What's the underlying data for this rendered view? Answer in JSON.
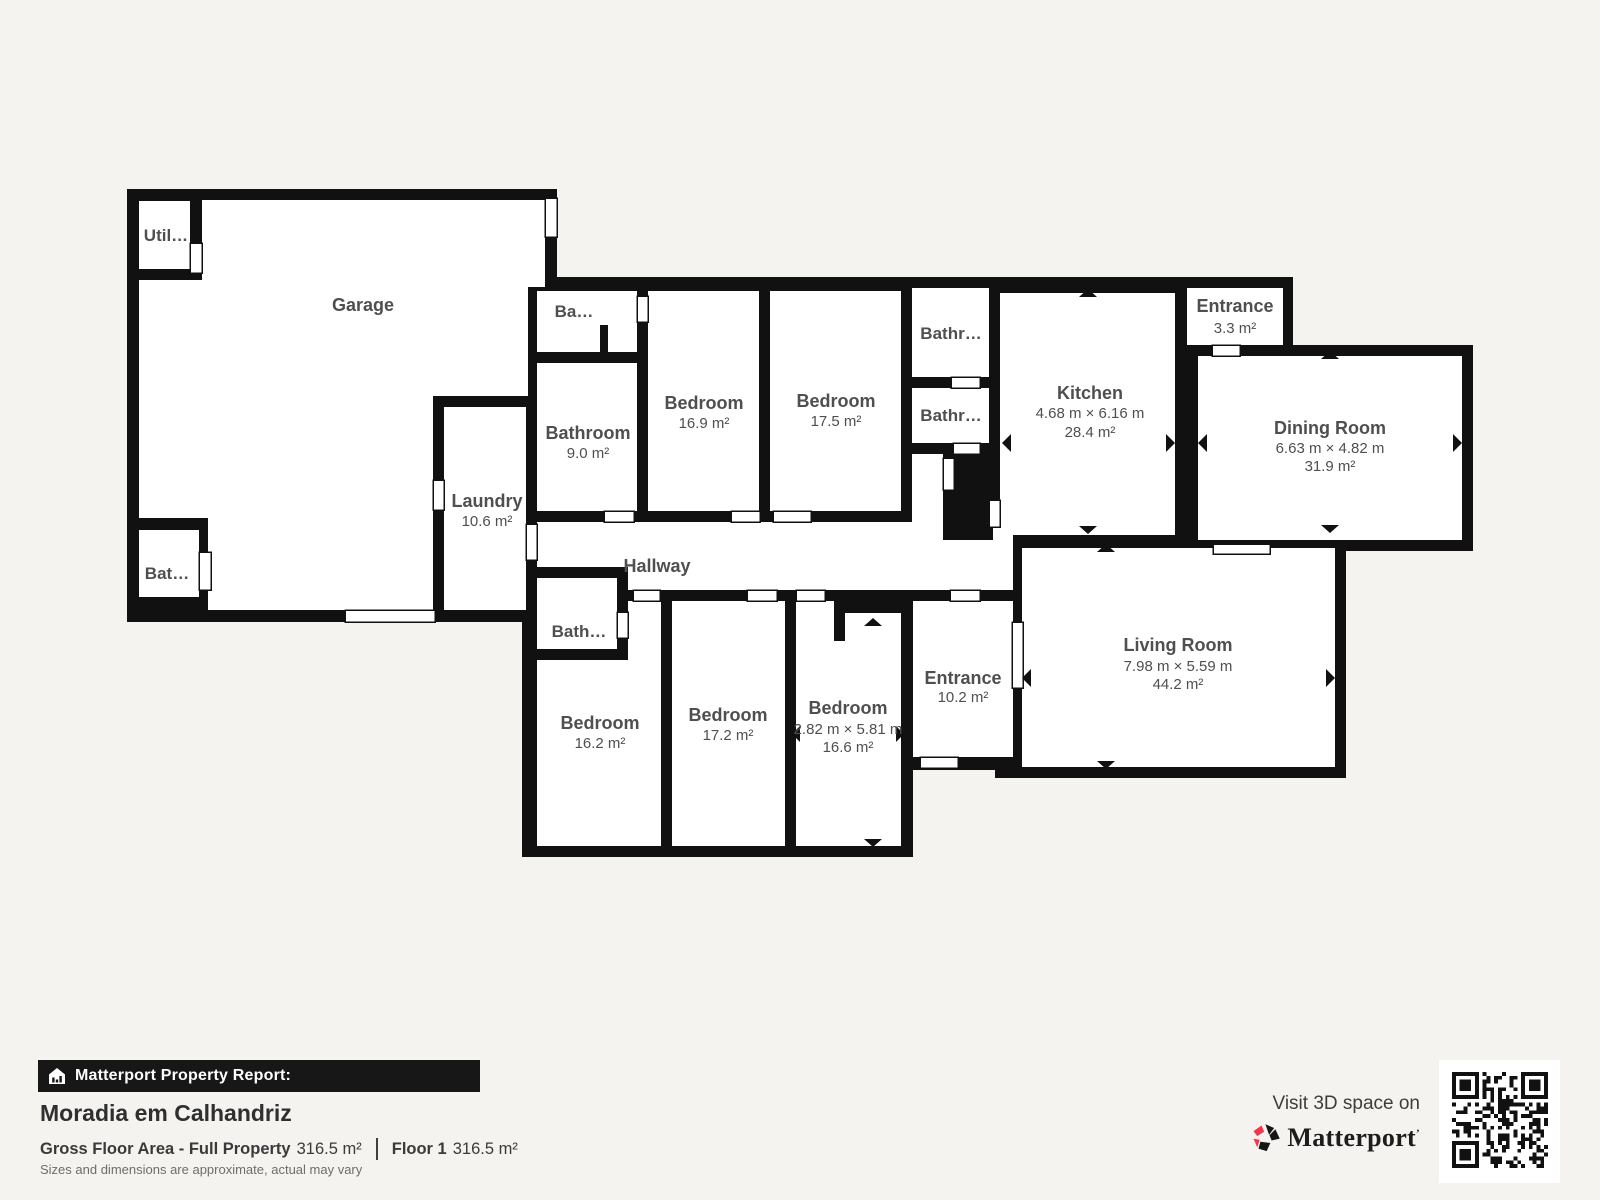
{
  "floorplan": {
    "colors": {
      "wall": "#111111",
      "background": "#f4f3f0",
      "room_fill": "#ffffff",
      "label": "#4f4f4f"
    },
    "rooms": {
      "garage": {
        "name": "Garage"
      },
      "utility": {
        "name": "Util…"
      },
      "bath_garage": {
        "name": "Bat…"
      },
      "laundry": {
        "name": "Laundry",
        "area": "10.6 m²"
      },
      "ba_small": {
        "name": "Ba…"
      },
      "bathroom_main": {
        "name": "Bathroom",
        "area": "9.0 m²"
      },
      "bedroom_1": {
        "name": "Bedroom",
        "area": "16.9 m²"
      },
      "bedroom_2": {
        "name": "Bedroom",
        "area": "17.5 m²"
      },
      "bathroom_top": {
        "name": "Bathr…"
      },
      "bathroom_mid": {
        "name": "Bathr…"
      },
      "kitchen": {
        "name": "Kitchen",
        "dims": "4.68 m × 6.16 m",
        "area": "28.4 m²"
      },
      "entrance_small": {
        "name": "Entrance",
        "area": "3.3 m²"
      },
      "dining": {
        "name": "Dining Room",
        "dims": "6.63 m × 4.82 m",
        "area": "31.9 m²"
      },
      "hallway": {
        "name": "Hallway"
      },
      "bath_lower": {
        "name": "Bath…"
      },
      "bedroom_3": {
        "name": "Bedroom",
        "area": "16.2 m²"
      },
      "bedroom_4": {
        "name": "Bedroom",
        "area": "17.2 m²"
      },
      "bedroom_5": {
        "name": "Bedroom",
        "dims": "2.82 m × 5.81 m",
        "area": "16.6 m²"
      },
      "entrance_main": {
        "name": "Entrance",
        "area": "10.2 m²"
      },
      "living": {
        "name": "Living Room",
        "dims": "7.98 m × 5.59 m",
        "area": "44.2 m²"
      }
    }
  },
  "footer": {
    "report_label": "Matterport Property Report:",
    "property_name": "Moradia em Calhandriz",
    "gross_label": "Gross Floor Area - Full Property",
    "gross_value": "316.5 m²",
    "floor_label": "Floor 1",
    "floor_value": "316.5 m²",
    "disclaimer": "Sizes and dimensions are approximate, actual may vary"
  },
  "branding": {
    "visit_text": "Visit 3D space on",
    "wordmark": "Matterport",
    "trademark": "’",
    "accent": "#f4364c"
  }
}
